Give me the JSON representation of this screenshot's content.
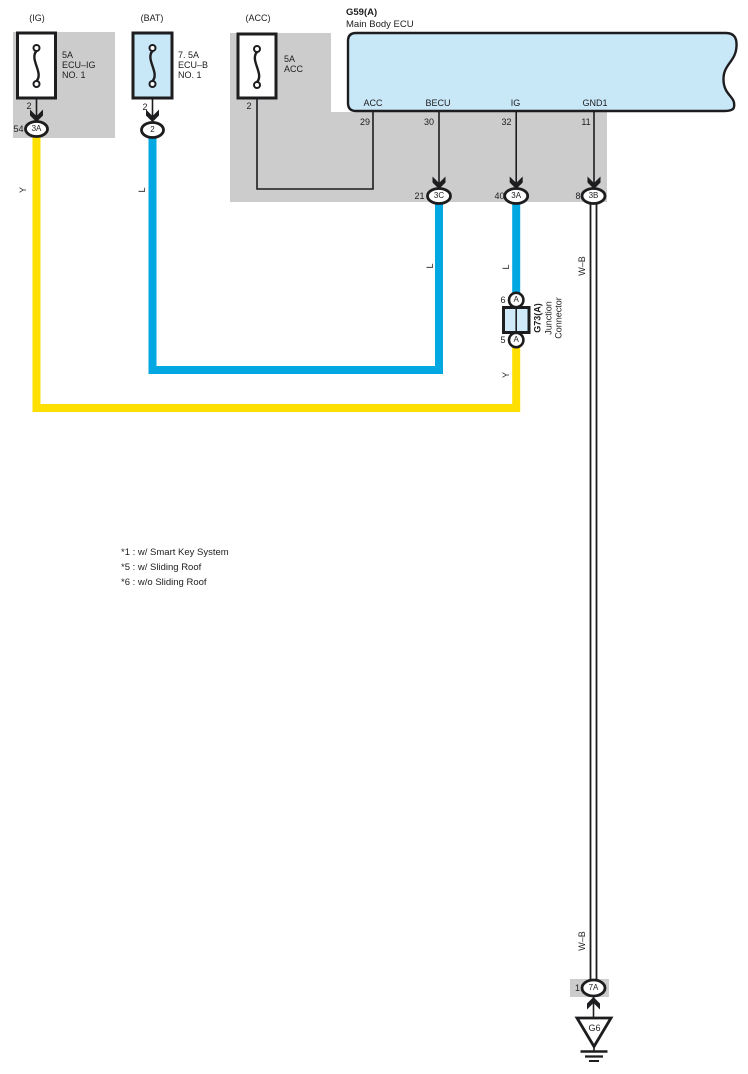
{
  "diagram_title": {
    "code": "G59(A)",
    "name": "Main Body ECU"
  },
  "fuses": [
    {
      "name": "(IG)",
      "rating": "5A",
      "label1": "ECU–IG",
      "label2": "NO. 1",
      "pin": "2",
      "terminal": "54",
      "connector": "3A",
      "wire_color_label": "Y"
    },
    {
      "name": "(BAT)",
      "rating": "7. 5A",
      "label1": "ECU–B",
      "label2": "NO. 1",
      "pin": "2",
      "connector": "2",
      "wire_color_label": "L"
    },
    {
      "name": "(ACC)",
      "rating": "5A",
      "label1": "ACC",
      "pin": "2"
    }
  ],
  "ecu_pins": [
    {
      "label": "ACC",
      "pin": "29"
    },
    {
      "label": "BECU",
      "pin": "30",
      "terminal": "21",
      "connector": "3C",
      "wire_color_label": "L"
    },
    {
      "label": "IG",
      "pin": "32",
      "terminal": "40",
      "connector": "3A",
      "wire_color_label": "L"
    },
    {
      "label": "GND1",
      "pin": "11",
      "terminal": "8",
      "connector": "3B",
      "wire_color_label": "W–B"
    }
  ],
  "junction_connector": {
    "code": "G73(A)",
    "label1": "Junction",
    "label2": "Connector",
    "top_pin": "6",
    "top_connector": "A",
    "bottom_pin": "5",
    "bottom_connector": "A",
    "lower_wire_color_label": "Y"
  },
  "ground": {
    "pin": "1",
    "connector": "7A",
    "code": "G6",
    "wire_color_label": "W–B"
  },
  "notes": [
    "*1 : w/ Smart Key System",
    "*5 : w/ Sliding Roof",
    "*6 : w/o Sliding Roof"
  ],
  "colors": {
    "wire_yellow": "#FFDF00",
    "wire_blue": "#00A7E1",
    "ecu_fill": "#C8E7F7",
    "junction_fill": "#CFE9F8",
    "block_gray": "#CCCCCC",
    "line_black": "#1D1D1F"
  }
}
